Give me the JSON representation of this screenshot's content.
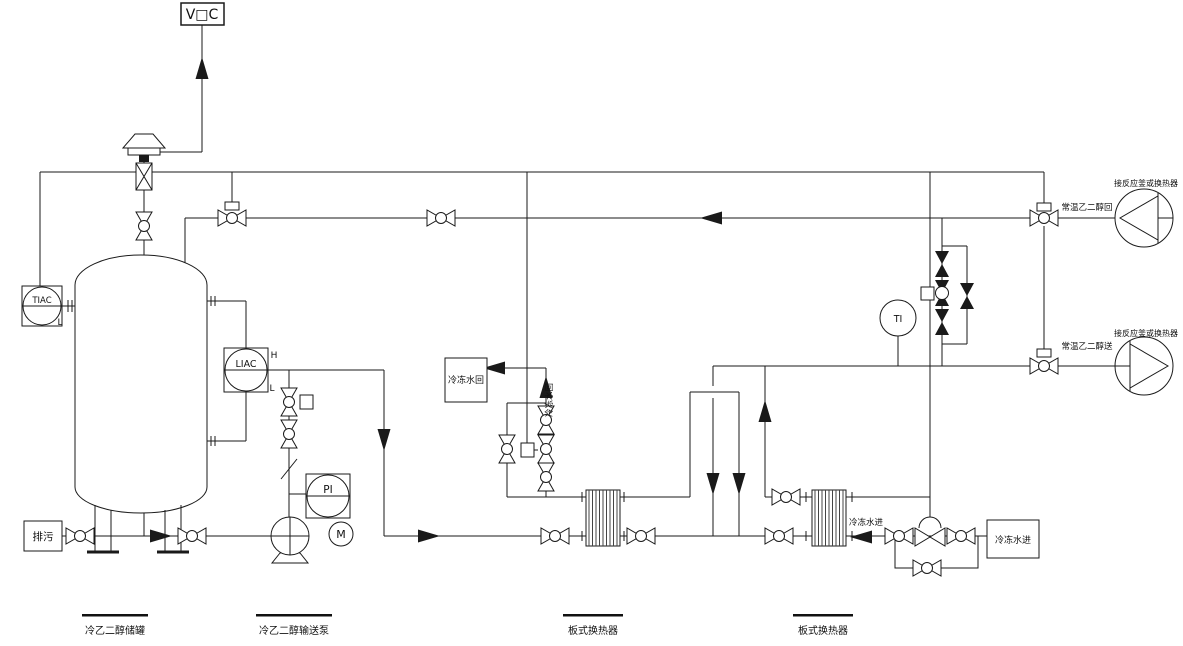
{
  "vent": {
    "voc_label": "V□C"
  },
  "instruments": {
    "tiac": "TIAC",
    "tiac_low": "L",
    "liac": "LIAC",
    "liac_high": "H",
    "liac_low": "L",
    "pi": "PI",
    "ti": "TI",
    "motor": "M"
  },
  "labels": {
    "drain": "排污",
    "cw_return_box": "冷冻水回",
    "cw_return_riser": "冷冻水回",
    "cw_inlet_floating": "冷冻水进",
    "cw_inlet_box": "冷冻水进",
    "glycol_return": "常温乙二醇回",
    "glycol_supply": "常温乙二醇送",
    "reactor_top": "接反应釜或换热器",
    "reactor_bottom": "接反应釜或换热器"
  },
  "equipment_labels": {
    "tank": "冷乙二醇储罐",
    "pump": "冷乙二醇输送泵",
    "hx1": "板式换热器",
    "hx2": "板式换热器"
  },
  "colors": {
    "line": "#1a1a1a",
    "background": "#ffffff"
  }
}
